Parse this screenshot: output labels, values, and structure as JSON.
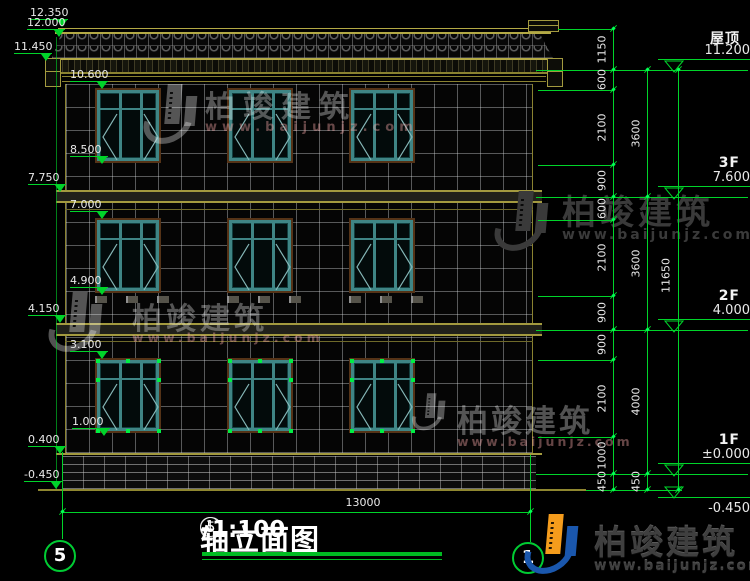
{
  "watermark": {
    "brand": "柏竣建筑",
    "url": "www.baijunjz.com"
  },
  "title_bar": {
    "axis_start": "5",
    "separator": "–",
    "axis_end": "1",
    "name": "轴立面图",
    "scale": "1:100"
  },
  "axes": {
    "left_bubble": "5",
    "right_bubble": "1"
  },
  "dimensions": {
    "overall_width": "13000",
    "overall_height": "11650",
    "chain_small": [
      "1150",
      "600",
      "2100",
      "900",
      "600",
      "2100",
      "900",
      "900",
      "2100",
      "1000",
      "450"
    ],
    "chain_floor": [
      "3600",
      "3600",
      "4000",
      "450"
    ]
  },
  "left_levels": [
    "12.350",
    "12.000",
    "11.450",
    "10.600",
    "8.500",
    "7.750",
    "7.000",
    "4.900",
    "4.150",
    "3.100",
    "1.000",
    "0.400",
    "-0.450"
  ],
  "right_levels": [
    {
      "label": "屋顶",
      "value": "11.200"
    },
    {
      "label": "3F",
      "value": "7.600"
    },
    {
      "label": "2F",
      "value": "4.000"
    },
    {
      "label": "1F",
      "value": "±0.000"
    },
    {
      "label": "",
      "value": "-0.450"
    }
  ],
  "colors": {
    "line_green": "#00d42a",
    "cad_yellow": "#a39a3f",
    "window_teal": "#3f8585",
    "brand_blue": "#1a57ad",
    "brand_orange": "#f59c1c"
  }
}
